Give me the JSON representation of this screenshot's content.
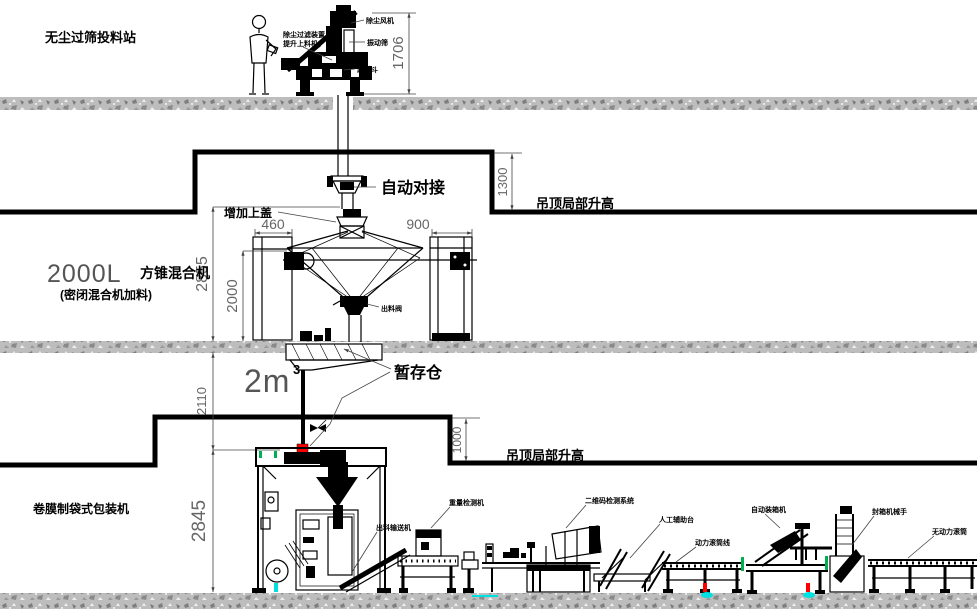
{
  "station": {
    "name": "无尘过筛投料站",
    "dim_height": "1706",
    "callouts": {
      "left_line1": "除尘过滤装置",
      "left_line2": "提升上料机",
      "right1": "除尘风机",
      "right2": "振动筛",
      "right3": "卸料斗"
    }
  },
  "mixer_floor": {
    "size": "2000L",
    "name": "方锥混合机",
    "sub": "(密闭混合机加料)",
    "auto_dock": "自动对接",
    "add_cover": "增加上盖",
    "ceiling_note": "吊顶局部升高",
    "discharge_valve": "出料阀",
    "dim_raise": "1300",
    "dim_overall": "2855",
    "dim_mixer": "2000",
    "dim_left_cabinet": "460",
    "dim_right_cabinet": "900"
  },
  "buffer": {
    "name": "暂存仓",
    "volume": "2m",
    "volume_exp": "3",
    "dim_drop": "2110"
  },
  "packing_floor": {
    "machine": "卷膜制袋式包装机",
    "ceiling_note": "吊顶局部升高",
    "dim_raise": "1000",
    "dim_height": "2845",
    "line": {
      "outfeed": "出料输送机",
      "checkweigher": "重量检测机",
      "qr_system": "二维码检测系统",
      "manual_table": "人工辅助台",
      "power_roller": "动力滚筒线",
      "case_packer": "自动装箱机",
      "case_robot": "封箱机械手",
      "free_roller": "无动力滚筒"
    }
  },
  "colors": {
    "accent_red": "#ff0000",
    "accent_green": "#00b050",
    "accent_cyan": "#00e0e0",
    "concrete_gray": "#bdbdbd"
  }
}
